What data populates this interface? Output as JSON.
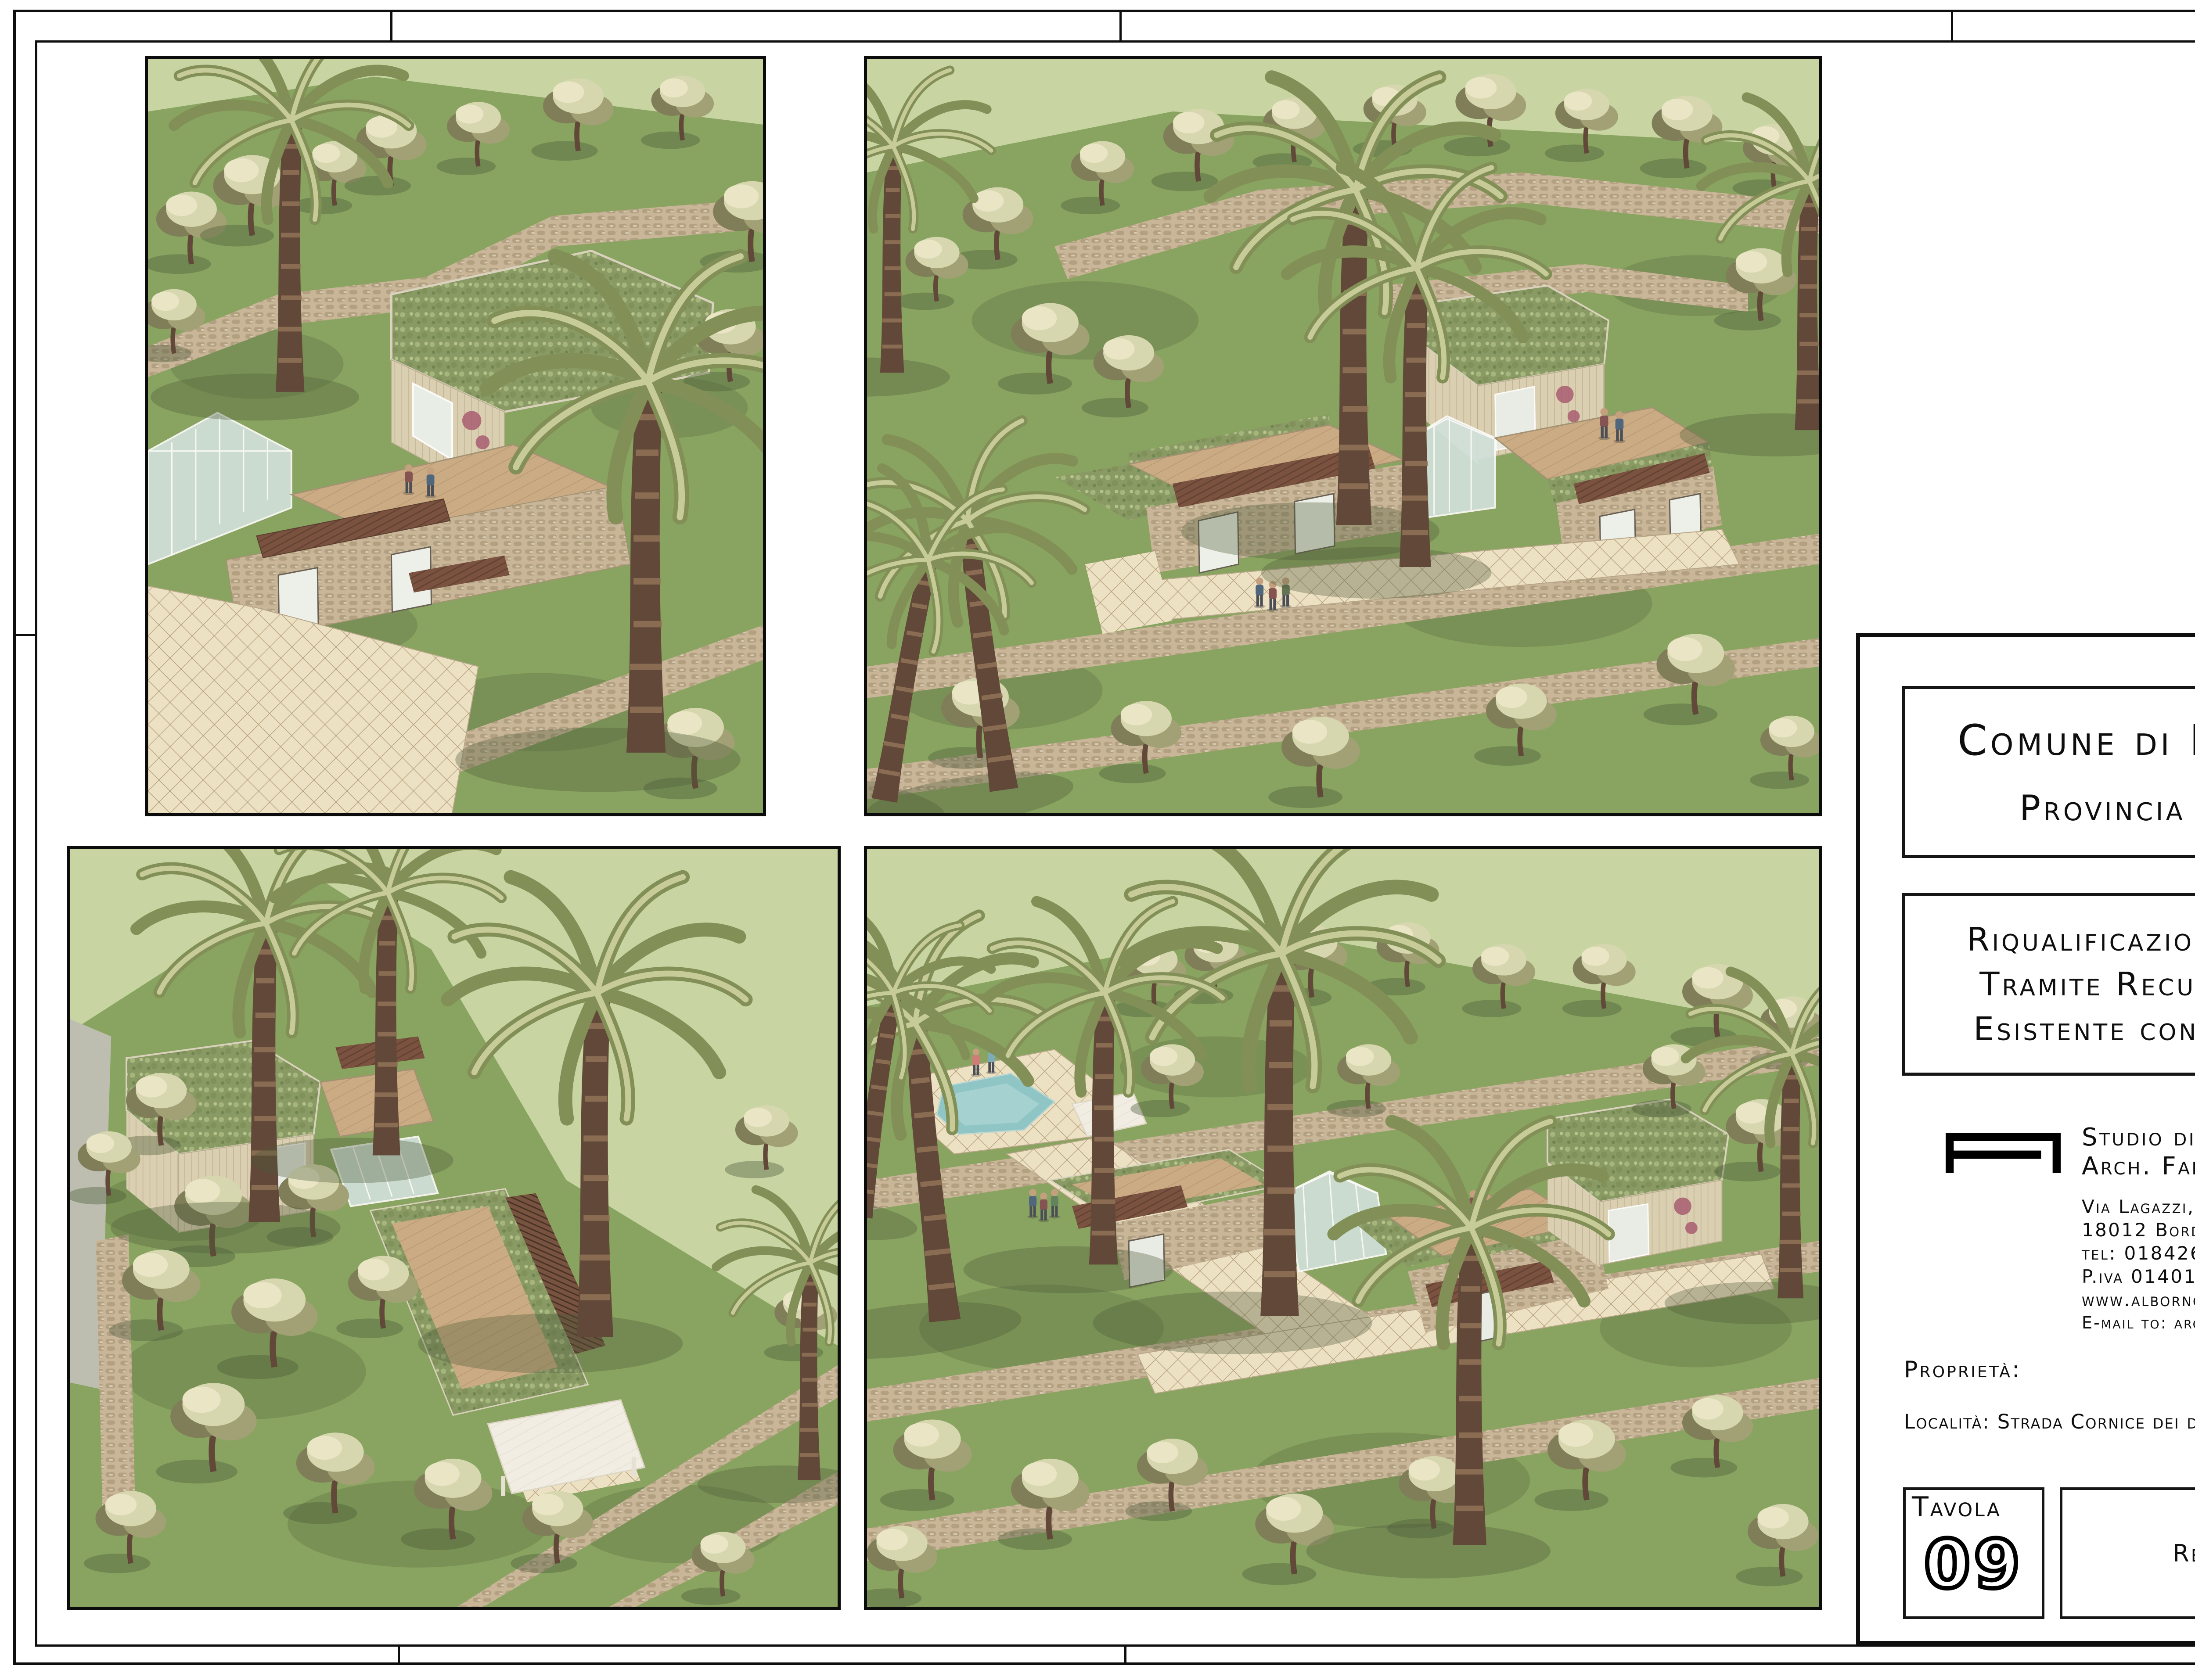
{
  "title_block": {
    "municipality": {
      "line1": "Comune di Bordighera",
      "line2": "Provincia di Imperia"
    },
    "project": {
      "line1": "Riqualificazione Ambientale",
      "line2": "Tramite Recupero Rustico",
      "line3": "Esistente con Ampliamento"
    },
    "studio": {
      "logo_icon": "alborno-monogram-icon",
      "name_line1": "Studio di Architettura",
      "name_line2": "Arch. Fabrizio Alborno",
      "address_line": "Via Lagazzi, 10",
      "city_line": "18012 Bordighera, im",
      "phone_line": "tel: 0184262529 fax: 0184268661",
      "vat_line": "P.iva 01401970080",
      "website_line": "www.alborno.com",
      "email_line": "E-mail to: arch.fabrizioalborno@gmail.com"
    },
    "property_label": "Proprietà:",
    "location_line": "Località: Strada Cornice dei due Golfi snc, Bordighera",
    "tavola": {
      "label": "Tavola",
      "number": "09"
    },
    "content": {
      "label": "Render"
    },
    "scala": {
      "label": "Scala:",
      "value": ""
    },
    "data": {
      "label": "Data:",
      "value": "19/07/19"
    }
  },
  "renders": [
    {
      "name": "render-view-1"
    },
    {
      "name": "render-view-2"
    },
    {
      "name": "render-view-3"
    },
    {
      "name": "render-view-4"
    }
  ],
  "colors": {
    "paper": "#ffffff",
    "ink": "#141414",
    "bg_green": "#c5d5a0",
    "grass": "#7e9f55",
    "grass_dark": "#42552e",
    "stone": "#c6b394",
    "stone_dark": "#94815f",
    "tile": "#eee2c3",
    "tile_line": "#a8916c",
    "deck": "#c7a67c",
    "deck_line": "#a3815a",
    "pergola": "#6e4330",
    "wood_clad": "#d9cfae",
    "roof_green": "#7e935a",
    "glass": "#cfe2dc",
    "pool": "#85c3c6",
    "trunk": "#52382a",
    "palm_green": "#76874a",
    "foliage": "#d4d6ad",
    "foliage_dark": "#73744c",
    "white_struct": "#f3f0e7",
    "accent_red": "#a14f68",
    "gray_terrain": "#b8bcae"
  }
}
